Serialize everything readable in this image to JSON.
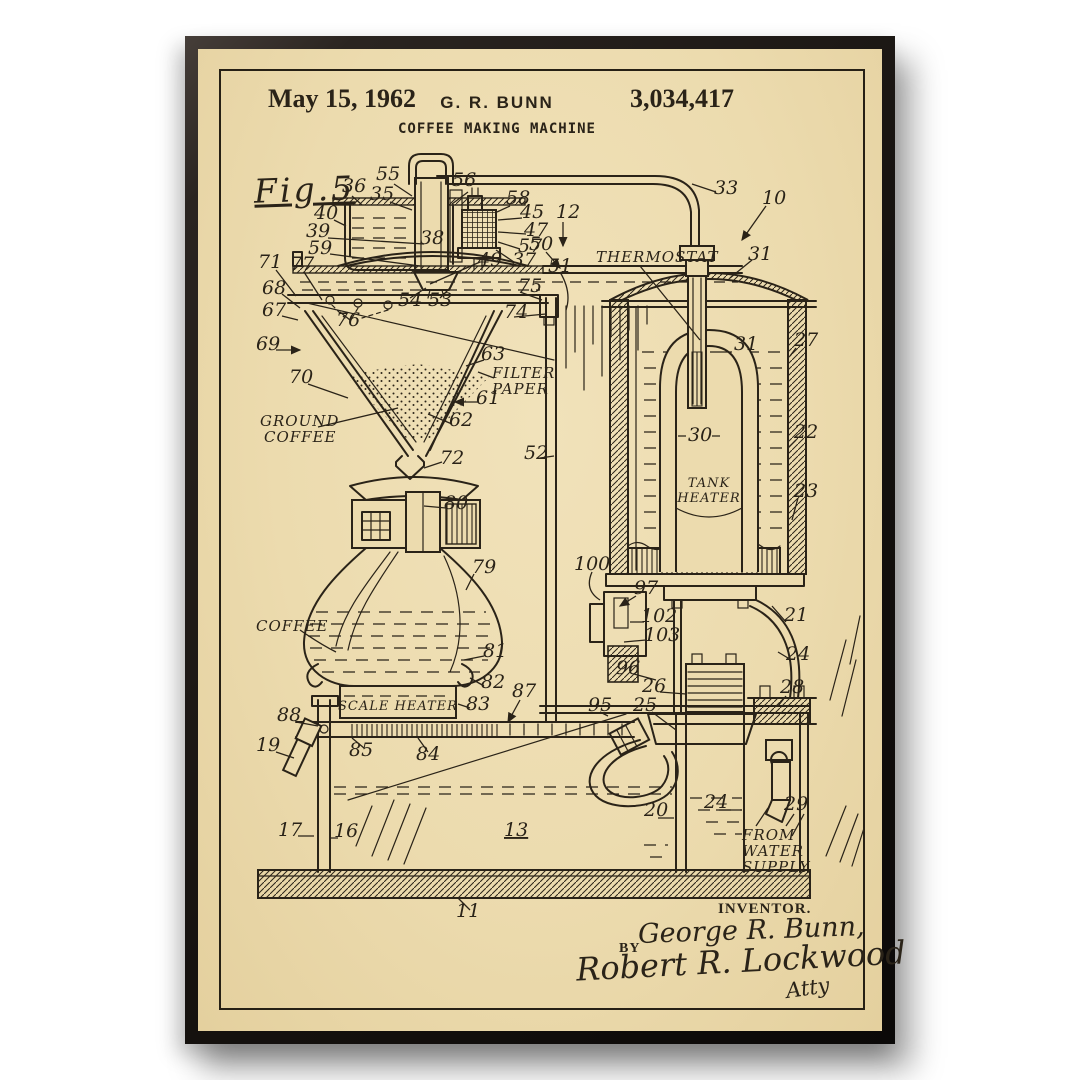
{
  "header": {
    "date": "May 15, 1962",
    "inventor": "G. R. BUNN",
    "patent_number": "3,034,417",
    "title": "COFFEE MAKING MACHINE"
  },
  "figure_label": "Fig.5",
  "signature": {
    "inventor_heading": "INVENTOR.",
    "inventor_name": "George R. Bunn,",
    "by_label": "BY",
    "attorney_signature": "Robert R. Lockwood",
    "attorney_suffix": "Atty"
  },
  "colors": {
    "paper": "#ecdbae",
    "ink": "#2a2318",
    "frame": "#16120f",
    "page_background": "#ffffff"
  },
  "drawing": {
    "labels": [
      {
        "t": "36",
        "x": 342,
        "y": 192
      },
      {
        "t": "55",
        "x": 376,
        "y": 180
      },
      {
        "t": "35",
        "x": 370,
        "y": 200
      },
      {
        "t": "56",
        "x": 452,
        "y": 186
      },
      {
        "t": "58",
        "x": 506,
        "y": 204
      },
      {
        "t": "45",
        "x": 520,
        "y": 218
      },
      {
        "t": "47",
        "x": 524,
        "y": 236
      },
      {
        "t": "57",
        "x": 518,
        "y": 252
      },
      {
        "t": "37",
        "x": 512,
        "y": 266
      },
      {
        "t": "40",
        "x": 314,
        "y": 219
      },
      {
        "t": "39",
        "x": 306,
        "y": 237
      },
      {
        "t": "59",
        "x": 308,
        "y": 254
      },
      {
        "t": "38",
        "x": 420,
        "y": 244
      },
      {
        "t": "12",
        "x": 556,
        "y": 218
      },
      {
        "t": "50",
        "x": 529,
        "y": 250
      },
      {
        "t": "51",
        "x": 548,
        "y": 272
      },
      {
        "t": "33",
        "x": 714,
        "y": 194
      },
      {
        "t": "10",
        "x": 762,
        "y": 204
      },
      {
        "t": "31",
        "x": 748,
        "y": 260
      },
      {
        "t": "49",
        "x": 478,
        "y": 266
      },
      {
        "t": "THERMOSTAT",
        "x": 596,
        "y": 262,
        "fs": 15,
        "w": 1
      },
      {
        "t": "71",
        "x": 258,
        "y": 268
      },
      {
        "t": "77",
        "x": 290,
        "y": 270
      },
      {
        "t": "68",
        "x": 262,
        "y": 294
      },
      {
        "t": "67",
        "x": 262,
        "y": 316
      },
      {
        "t": "76",
        "x": 336,
        "y": 326
      },
      {
        "t": "54",
        "x": 398,
        "y": 306
      },
      {
        "t": "53",
        "x": 428,
        "y": 306
      },
      {
        "t": "75",
        "x": 518,
        "y": 292
      },
      {
        "t": "74",
        "x": 504,
        "y": 318
      },
      {
        "t": "69",
        "x": 256,
        "y": 350
      },
      {
        "t": "70",
        "x": 289,
        "y": 383
      },
      {
        "t": "63",
        "x": 481,
        "y": 360
      },
      {
        "t": "FILTER",
        "x": 492,
        "y": 378,
        "fs": 15,
        "w": 1
      },
      {
        "t": "PAPER",
        "x": 492,
        "y": 394,
        "fs": 15,
        "w": 1
      },
      {
        "t": "61",
        "x": 476,
        "y": 404
      },
      {
        "t": "62",
        "x": 449,
        "y": 426
      },
      {
        "t": "GROUND",
        "x": 260,
        "y": 426,
        "fs": 15,
        "w": 1
      },
      {
        "t": "COFFEE",
        "x": 264,
        "y": 442,
        "fs": 15,
        "w": 1
      },
      {
        "t": "72",
        "x": 440,
        "y": 464
      },
      {
        "t": "52",
        "x": 524,
        "y": 459
      },
      {
        "t": "31",
        "x": 734,
        "y": 350
      },
      {
        "t": "27",
        "x": 794,
        "y": 346
      },
      {
        "t": "30",
        "x": 688,
        "y": 441
      },
      {
        "t": "22",
        "x": 794,
        "y": 438
      },
      {
        "t": "TANK",
        "x": 709,
        "y": 487,
        "fs": 13,
        "w": 1,
        "a": "middle"
      },
      {
        "t": "HEATER",
        "x": 709,
        "y": 502,
        "fs": 13,
        "w": 1,
        "a": "middle"
      },
      {
        "t": "23",
        "x": 794,
        "y": 497
      },
      {
        "t": "80",
        "x": 444,
        "y": 509
      },
      {
        "t": "79",
        "x": 472,
        "y": 573
      },
      {
        "t": "COFFEE",
        "x": 256,
        "y": 631,
        "fs": 15,
        "w": 1
      },
      {
        "t": "81",
        "x": 483,
        "y": 657
      },
      {
        "t": "82",
        "x": 481,
        "y": 688
      },
      {
        "t": "83",
        "x": 466,
        "y": 710
      },
      {
        "t": "SCALE HEATER",
        "x": 398,
        "y": 710,
        "fs": 13,
        "w": 1,
        "a": "middle"
      },
      {
        "t": "87",
        "x": 512,
        "y": 697
      },
      {
        "t": "88",
        "x": 277,
        "y": 721
      },
      {
        "t": "19",
        "x": 256,
        "y": 751
      },
      {
        "t": "85",
        "x": 349,
        "y": 756
      },
      {
        "t": "84",
        "x": 416,
        "y": 760
      },
      {
        "t": "95",
        "x": 588,
        "y": 711
      },
      {
        "t": "96",
        "x": 616,
        "y": 674
      },
      {
        "t": "26",
        "x": 642,
        "y": 692
      },
      {
        "t": "25",
        "x": 633,
        "y": 711
      },
      {
        "t": "100",
        "x": 574,
        "y": 570
      },
      {
        "t": "97",
        "x": 634,
        "y": 594
      },
      {
        "t": "102",
        "x": 641,
        "y": 622
      },
      {
        "t": "103",
        "x": 644,
        "y": 641
      },
      {
        "t": "21",
        "x": 784,
        "y": 621
      },
      {
        "t": "24",
        "x": 786,
        "y": 660
      },
      {
        "t": "28",
        "x": 780,
        "y": 693
      },
      {
        "t": "20",
        "x": 644,
        "y": 816
      },
      {
        "t": "24",
        "x": 704,
        "y": 808
      },
      {
        "t": "29",
        "x": 784,
        "y": 810
      },
      {
        "t": "FROM",
        "x": 742,
        "y": 840,
        "fs": 15,
        "w": 1
      },
      {
        "t": "WATER",
        "x": 742,
        "y": 856,
        "fs": 15,
        "w": 1
      },
      {
        "t": "SUPPLY",
        "x": 742,
        "y": 872,
        "fs": 15,
        "w": 1
      },
      {
        "t": "17",
        "x": 278,
        "y": 836
      },
      {
        "t": "16",
        "x": 334,
        "y": 837
      },
      {
        "t": "13",
        "x": 504,
        "y": 836,
        "u": 1
      },
      {
        "t": "11",
        "x": 456,
        "y": 917
      }
    ]
  }
}
